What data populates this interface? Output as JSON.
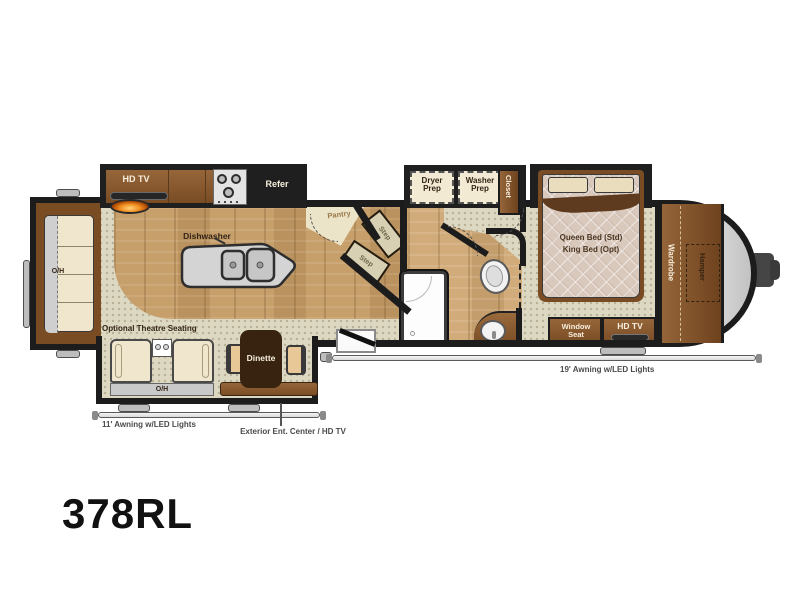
{
  "model_number": "378RL",
  "floorplan": {
    "living": {
      "tv": "HD TV",
      "refer": "Refer",
      "dishwasher": "Dishwasher",
      "rear_overhead": "O/H",
      "theatre": "Optional Theatre Seating",
      "theatre_overhead": "O/H",
      "dinette": "Dinette"
    },
    "kitchen": {
      "pantry": "Pantry",
      "step_upper": "Step",
      "step_lower": "Step"
    },
    "utility": {
      "dryer": "Dryer Prep",
      "washer": "Washer Prep",
      "closet": "Closet"
    },
    "bedroom": {
      "bed_line1": "Queen Bed (Std)",
      "bed_line2": "King Bed (Opt)",
      "wardrobe": "Wardrobe",
      "hamper": "Hamper",
      "window_seat": "Window Seat",
      "tv": "HD TV"
    },
    "exterior": {
      "awning_rear": "11' Awning w/LED Lights",
      "awning_front": "19' Awning w/LED Lights",
      "ent_center": "Exterior Ent. Center / HD TV"
    }
  },
  "colors": {
    "wall": "#1c1c1c",
    "wood_floor": "#c79f6b",
    "carpet": "#ddd8c2",
    "cabinet_brown": "#8a5a2e",
    "dark_brown": "#37230f",
    "island_gray": "#d4d4d4",
    "cream": "#efe6cd",
    "flame_orange": "#f08c1e",
    "front_cap_gray": "#c9c9c9"
  }
}
